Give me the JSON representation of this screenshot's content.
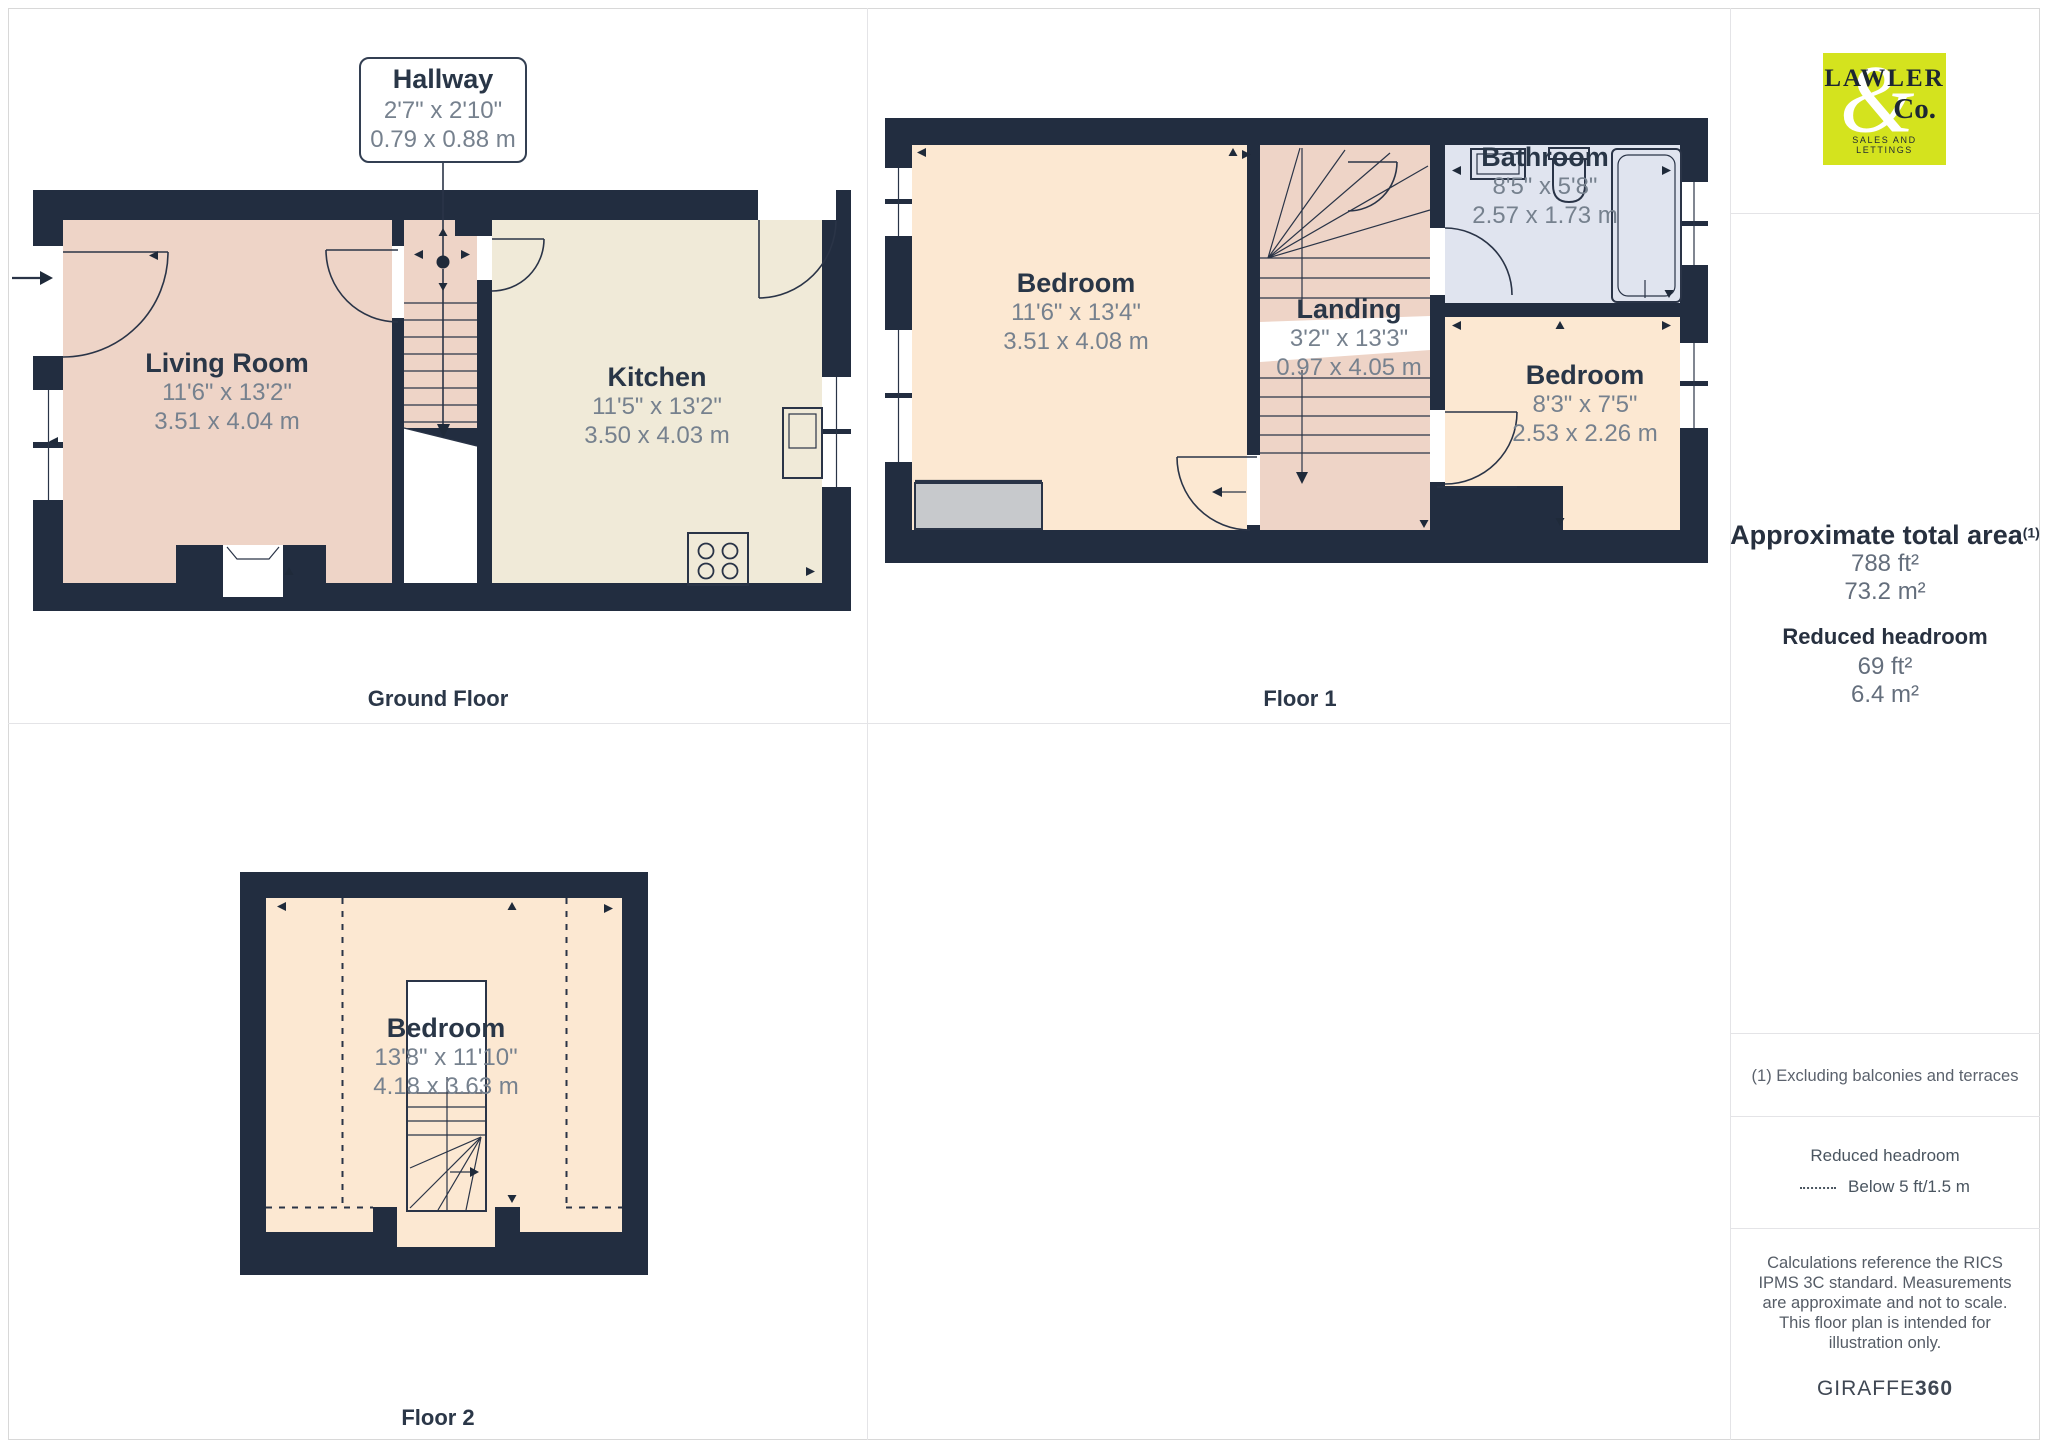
{
  "branding": {
    "word": "LAWLER",
    "amp": "&",
    "co": "Co.",
    "tagline": "SALES AND LETTINGS",
    "bg_color": "#d4e31e"
  },
  "floors": [
    {
      "label": "Ground Floor",
      "rooms": [
        {
          "name": "Hallway",
          "dims_ft": "2'7\" x 2'10\"",
          "dims_m": "0.79 x 0.88 m"
        },
        {
          "name": "Living Room",
          "dims_ft": "11'6\" x 13'2\"",
          "dims_m": "3.51 x 4.04 m"
        },
        {
          "name": "Kitchen",
          "dims_ft": "11'5\" x 13'2\"",
          "dims_m": "3.50 x 4.03 m"
        }
      ]
    },
    {
      "label": "Floor 1",
      "rooms": [
        {
          "name": "Bedroom",
          "dims_ft": "11'6\" x 13'4\"",
          "dims_m": "3.51 x 4.08 m"
        },
        {
          "name": "Landing",
          "dims_ft": "3'2\" x 13'3\"",
          "dims_m": "0.97 x 4.05 m"
        },
        {
          "name": "Bathroom",
          "dims_ft": "8'5\" x 5'8\"",
          "dims_m": "2.57 x 1.73 m"
        },
        {
          "name": "Bedroom",
          "dims_ft": "8'3\" x 7'5\"",
          "dims_m": "2.53 x 2.26 m"
        }
      ]
    },
    {
      "label": "Floor 2",
      "rooms": [
        {
          "name": "Bedroom",
          "dims_ft": "13'8\" x 11'10\"",
          "dims_m": "4.18 x 3.63 m"
        }
      ]
    }
  ],
  "sidebar": {
    "area_title": "Approximate total area",
    "area_sup": "(1)",
    "area_ft": "788 ft²",
    "area_m": "73.2 m²",
    "reduced_title": "Reduced headroom",
    "reduced_ft": "69 ft²",
    "reduced_m": "6.4 m²",
    "note": "(1) Excluding balconies and terraces",
    "legend_title": "Reduced headroom",
    "legend_value": "Below 5 ft/1.5 m",
    "disclaimer": "Calculations reference the RICS IPMS 3C standard. Measurements are approximate and not to scale. This floor plan is intended for illustration only.",
    "brand": "GIRAFFE",
    "brand_bold": "360"
  },
  "colors": {
    "wall": "#222d40",
    "pink": "#eed4c7",
    "cream": "#f0ead8",
    "peach": "#fce8d2",
    "bathroom": "#e0e4ef",
    "balcony_gray": "#c7c9cc",
    "logo_lime": "#d4e31e"
  }
}
